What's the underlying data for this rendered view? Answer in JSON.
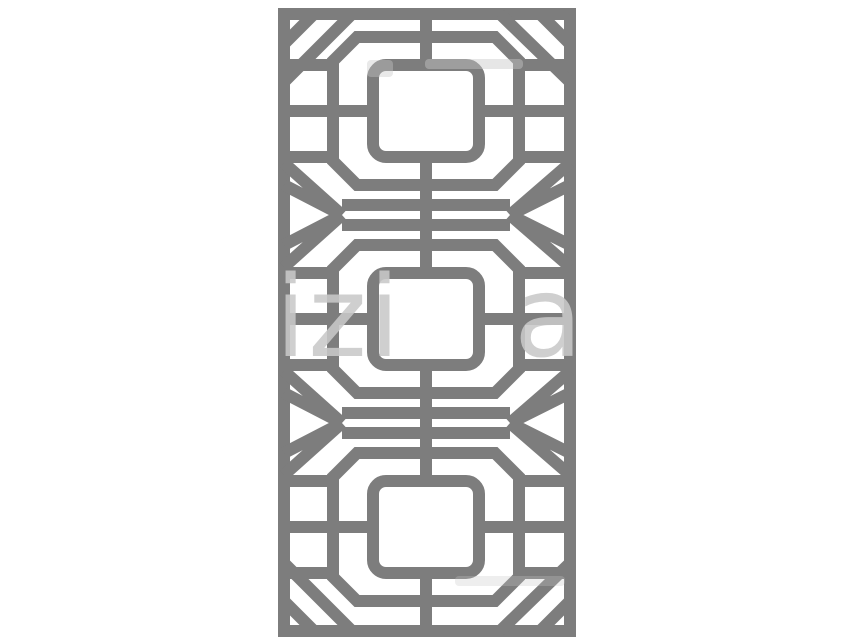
{
  "canvas": {
    "width": 850,
    "height": 638,
    "background": "#ffffff"
  },
  "lattice": {
    "stroke_color": "#7d7d7d",
    "stroke_width": 12,
    "frame": {
      "left": 284,
      "top": 14,
      "right": 570,
      "bottom": 631
    },
    "center_x": 426,
    "motif_centers_y": [
      111,
      319,
      527
    ],
    "band_centers_y": [
      215,
      423
    ],
    "octagon": {
      "half_width": 93,
      "bar_half_width": 69,
      "half_height": 74,
      "side_half_height": 50
    },
    "square": {
      "half_width": 53,
      "half_height": 46,
      "corner_radius": 13
    },
    "side_bar_offset_y": 46,
    "rails": {
      "offset_y": 10,
      "x_start": 342,
      "x_end": 510
    },
    "band_diagonal_frame_offsets": [
      30,
      52
    ],
    "corner_chamfer": 30,
    "corner_diagonal": {
      "top_dx_from_center": 74,
      "frame_drop": 68
    }
  },
  "watermark": {
    "left_text": "izi",
    "right_text": "a",
    "color": "#c8c8c8",
    "opacity": 0.88,
    "font_size": 112,
    "left_x": 275,
    "right_x": 514,
    "baseline_y": 356,
    "streaks": [
      {
        "x": 425,
        "y": 59,
        "w": 98,
        "h": 10,
        "opacity": 0.45
      },
      {
        "x": 367,
        "y": 60,
        "w": 26,
        "h": 17,
        "opacity": 0.4
      },
      {
        "x": 455,
        "y": 576,
        "w": 110,
        "h": 10,
        "opacity": 0.3
      }
    ]
  }
}
